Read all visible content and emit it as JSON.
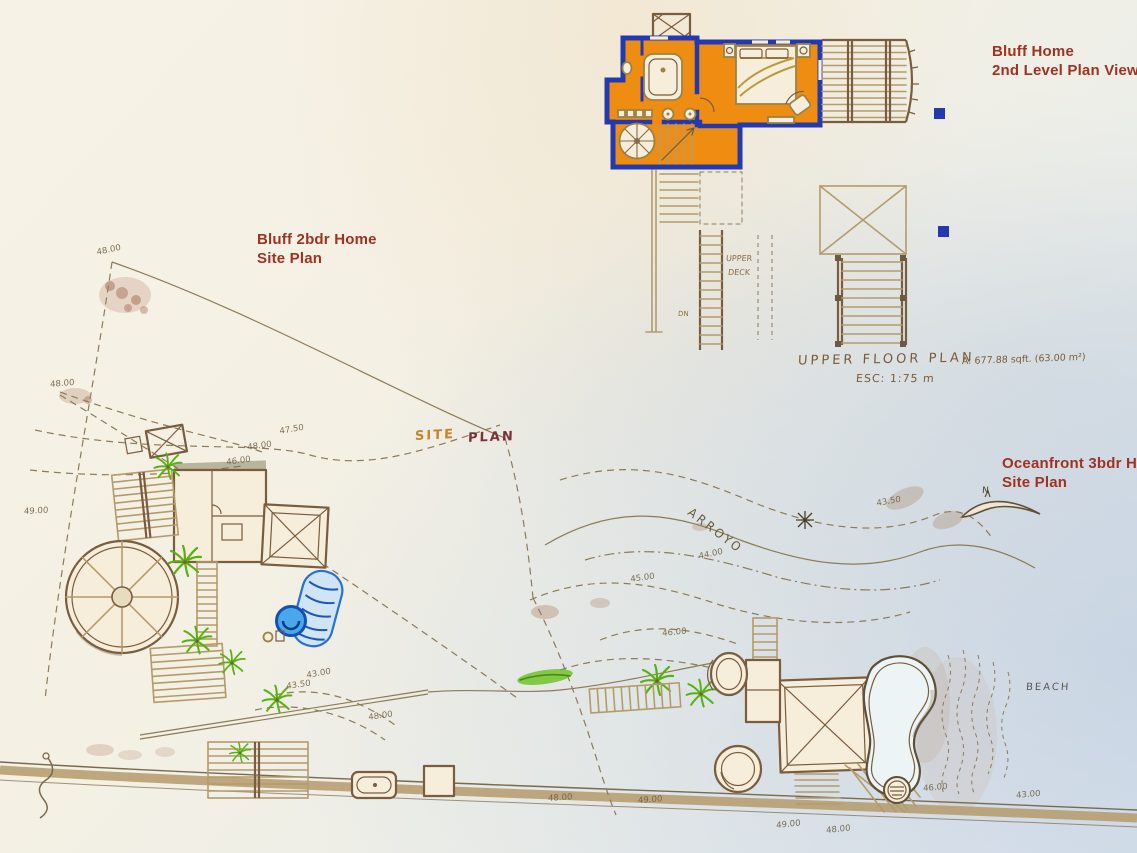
{
  "titles": {
    "bluff_home": {
      "line1": "Bluff Home",
      "line2": "2nd Level Plan View"
    },
    "bluff_site": {
      "line1": "Bluff  2bdr Home",
      "line2": "Site Plan"
    },
    "oceanfront": {
      "line1": "Oceanfront 3bdr Ho",
      "line2": "Site Plan"
    }
  },
  "annotations": {
    "upper_floor_plan": "UPPER FLOOR PLAN",
    "scale": "ESC: 1:75 m",
    "area": "A: 677.88 sqft. (63.00 m²)",
    "site_word": "SITE",
    "plan_word": "PLAN",
    "upper_deck_line1": "UPPER",
    "upper_deck_line2": "DECK",
    "dn": "DN",
    "arroyo": "ARROYO",
    "beach": "BEACH",
    "north": "N"
  },
  "colors": {
    "paper": "#f6f1e4",
    "cream": "#f6eedb",
    "orange": "#ef8d13",
    "blue": "#2239b0",
    "red": "#a03222",
    "ink": "#7b5b3a",
    "line": "#8d7b57",
    "struct": "#b49b6b",
    "frame": "#7a5c3e",
    "green": "#57b112",
    "poolblue": "#2a6fd4",
    "pooldeep": "#1d55b8",
    "spa": "#49a8ec",
    "roadtan": "#b59a6b"
  },
  "elevations": [
    {
      "t": "48.00",
      "x": 96,
      "y": 248,
      "r": -12
    },
    {
      "t": "48.00",
      "x": 50,
      "y": 380,
      "r": -5
    },
    {
      "t": "49.00",
      "x": 24,
      "y": 507,
      "r": -3
    },
    {
      "t": "47.50",
      "x": 279,
      "y": 427,
      "r": -10
    },
    {
      "t": "48.00",
      "x": 247,
      "y": 443,
      "r": -8
    },
    {
      "t": "46.00",
      "x": 226,
      "y": 458,
      "r": -8
    },
    {
      "t": "43.50",
      "x": 876,
      "y": 499,
      "r": -10
    },
    {
      "t": "44.00",
      "x": 698,
      "y": 552,
      "r": -12
    },
    {
      "t": "45.00",
      "x": 630,
      "y": 575,
      "r": -8
    },
    {
      "t": "46.00",
      "x": 662,
      "y": 629,
      "r": -6
    },
    {
      "t": "43.00",
      "x": 306,
      "y": 671,
      "r": -10
    },
    {
      "t": "43.50",
      "x": 286,
      "y": 682,
      "r": -8
    },
    {
      "t": "48.00",
      "x": 368,
      "y": 713,
      "r": -8
    },
    {
      "t": "48.00",
      "x": 548,
      "y": 794,
      "r": -4
    },
    {
      "t": "49.00",
      "x": 638,
      "y": 796,
      "r": -4
    },
    {
      "t": "49.00",
      "x": 776,
      "y": 821,
      "r": -6
    },
    {
      "t": "48.00",
      "x": 826,
      "y": 826,
      "r": -6
    },
    {
      "t": "46.00",
      "x": 923,
      "y": 784,
      "r": -5
    },
    {
      "t": "43.00",
      "x": 1016,
      "y": 791,
      "r": -5
    }
  ]
}
